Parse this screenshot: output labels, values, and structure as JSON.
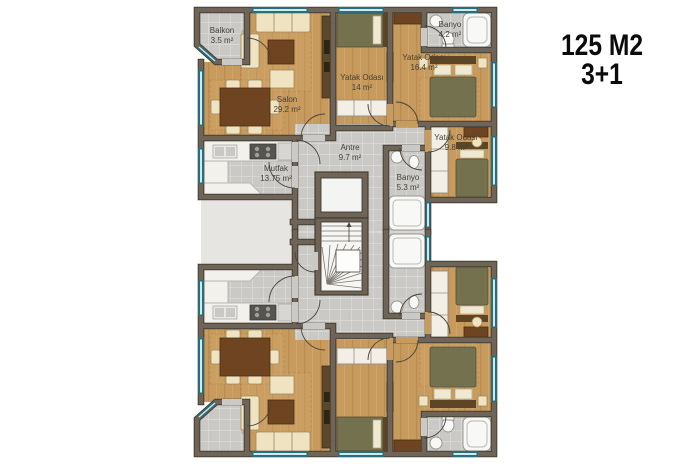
{
  "title": {
    "line1": "125 M2",
    "line2": "3+1"
  },
  "rooms": {
    "balkon": {
      "name": "Balkon",
      "area": "3.5 m²"
    },
    "salon": {
      "name": "Salon",
      "area": "29.2 m²"
    },
    "yatak_odasi_1": {
      "name": "Yatak Odası",
      "area": "14 m²"
    },
    "banyo_ust": {
      "name": "Banyo",
      "area": "4.2 m²"
    },
    "yatak_odasi_2": {
      "name": "Yatak Odası",
      "area": "16.4 m²"
    },
    "yatak_odasi_3": {
      "name": "Yatak Odası",
      "area": "9.8 m²"
    },
    "antre": {
      "name": "Antre",
      "area": "9.7 m²"
    },
    "mutfak": {
      "name": "Mutfak",
      "area": "13.75 m²"
    },
    "banyo_ic": {
      "name": "Banyo",
      "area": "5.3 m²"
    }
  },
  "colors": {
    "wood_floor": "#c79a5e",
    "tile_floor": "#cac9c6",
    "wall": "#6e6457",
    "window_frame": "#2a6e79",
    "window_glass": "#cfe9ee",
    "title_text": "#0b0b0b",
    "label_text": "#474139"
  }
}
